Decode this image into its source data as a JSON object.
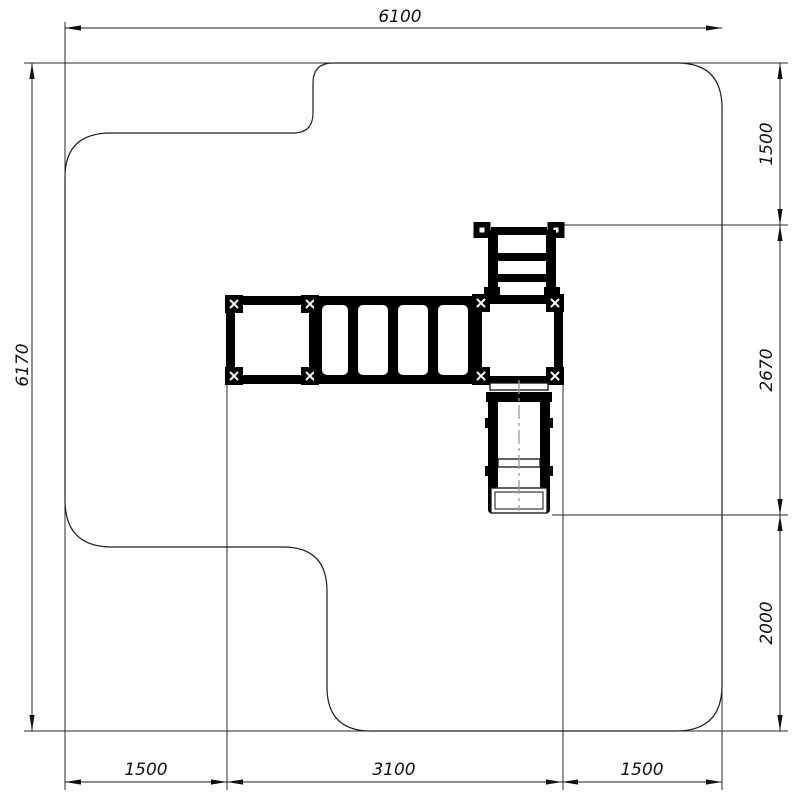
{
  "drawing": {
    "description": "plan-view-technical-drawing",
    "dims": {
      "top": "6100",
      "left": "6170",
      "right_top": "1500",
      "right_middle": "2670",
      "right_bottom": "2000",
      "bottom_left": "1500",
      "bottom_middle": "3100",
      "bottom_right": "1500"
    },
    "colors": {
      "background": "#ffffff",
      "line": "#1f1f1f",
      "structure": "#000000",
      "centerline": "#9b9b9b"
    }
  }
}
